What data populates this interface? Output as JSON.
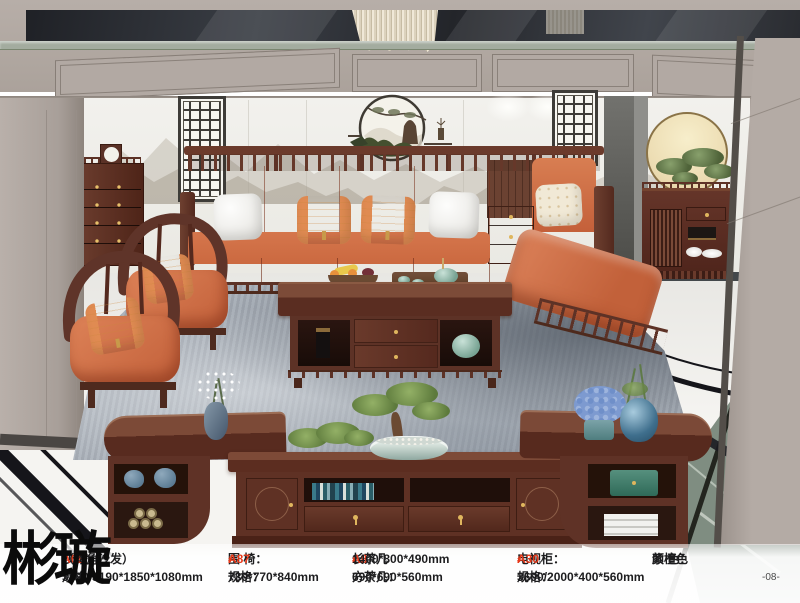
{
  "page": {
    "page_number": "-08-",
    "brand_watermark": "彬璇",
    "colors": {
      "accent_red": "#e8391a",
      "text_black": "#1d1d1f",
      "sofa_orange": "#cf7148",
      "wood_purple_sandal": "#57291d",
      "wall_taupe": "#b2a9a3",
      "marble_white": "#f2f1ed",
      "rug_gray": "#a6adb6"
    }
  },
  "specs": {
    "sofa": {
      "label": "沙 发：",
      "code": "A68",
      "hash": "#",
      "note": "（转角沙发）",
      "size_label": "规格：",
      "size": "3820/3190*1850*1080mm"
    },
    "armchair": {
      "label": "围  椅：",
      "code": "A87",
      "hash": "#",
      "size_label": "规格：",
      "size": "730*770*840mm"
    },
    "tea_long": {
      "label": "长茶几 ",
      "code": "A8",
      "hash": "#",
      "colon": "：",
      "size": "1400*800*490mm"
    },
    "tea_square": {
      "label": "方茶几：",
      "size": "690*690*560mm"
    },
    "tv": {
      "label": "电视柜：",
      "code": "A30",
      "hash": "#",
      "size_label": "规格：",
      "size": "3600/2000*400*560mm"
    },
    "color": {
      "label": "颜  色：",
      "value": "紫檀色"
    }
  }
}
